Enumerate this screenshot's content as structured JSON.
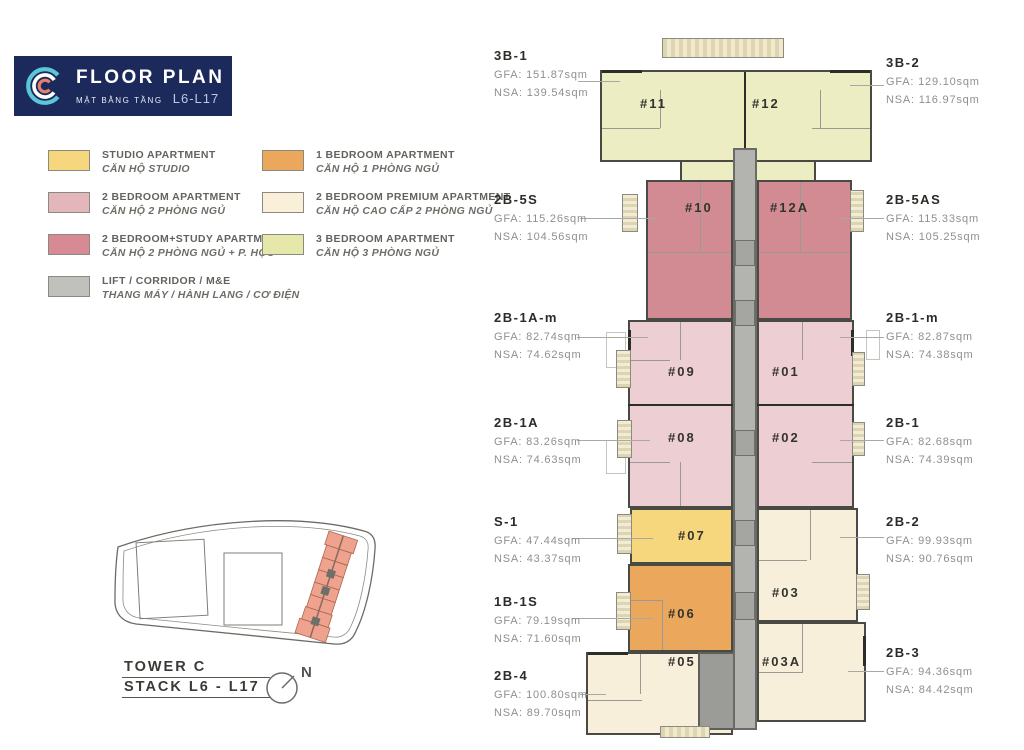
{
  "header": {
    "title": "FLOOR PLAN",
    "subtitle_vi": "MẶT BẰNG TẦNG",
    "levels": "L6-L17"
  },
  "legend": {
    "items": [
      {
        "label": "STUDIO APARTMENT",
        "label_vi": "CĂN HỘ STUDIO",
        "color": "#F6D77E"
      },
      {
        "label": "1 BEDROOM APARTMENT",
        "label_vi": "CĂN HỘ 1 PHÒNG NGỦ",
        "color": "#EBA85C"
      },
      {
        "label": "2 BEDROOM APARTMENT",
        "label_vi": "CĂN HỘ 2 PHÒNG NGỦ",
        "color": "#E3B6BC"
      },
      {
        "label": "2 BEDROOM PREMIUM APARTMENT",
        "label_vi": "CĂN HỘ CAO CẤP 2 PHÒNG NGỦ",
        "color": "#FAF0DA"
      },
      {
        "label": "2 BEDROOM+STUDY APARTMENT",
        "label_vi": "CĂN HỘ 2 PHÒNG NGỦ + P. HỌC",
        "color": "#D88A94"
      },
      {
        "label": "3 BEDROOM APARTMENT",
        "label_vi": "CĂN HỘ 3 PHÒNG NGỦ",
        "color": "#E5E8A9"
      },
      {
        "label": "LIFT / CORRIDOR / M&E",
        "label_vi": "THANG MÁY / HÀNH LANG / CƠ ĐIỆN",
        "color": "#C0C0BC"
      }
    ]
  },
  "site_plan": {
    "tower_label": "TOWER C",
    "stack_label": "STACK L6 - L17",
    "north_label": "N",
    "highlight_color": "#EFA28E"
  },
  "plan": {
    "units": [
      {
        "id": "#11",
        "type": "3-bedroom",
        "color": "#ECEDC3"
      },
      {
        "id": "#12",
        "type": "3-bedroom",
        "color": "#ECEDC3"
      },
      {
        "id": "#10",
        "type": "2-bedroom-study",
        "color": "#D28B92"
      },
      {
        "id": "#12A",
        "type": "2-bedroom-study",
        "color": "#D28B92"
      },
      {
        "id": "#09",
        "type": "2-bedroom",
        "color": "#EDCED2"
      },
      {
        "id": "#01",
        "type": "2-bedroom",
        "color": "#EDCED2"
      },
      {
        "id": "#08",
        "type": "2-bedroom",
        "color": "#EDCED2"
      },
      {
        "id": "#02",
        "type": "2-bedroom",
        "color": "#EDCED2"
      },
      {
        "id": "#07",
        "type": "studio",
        "color": "#F6D77E"
      },
      {
        "id": "#03",
        "type": "2-bedroom-premium",
        "color": "#F7EFD9"
      },
      {
        "id": "#06",
        "type": "1-bedroom",
        "color": "#EBA85C"
      },
      {
        "id": "#05",
        "type": "2-bedroom-premium",
        "color": "#F7EFD9"
      },
      {
        "id": "#03A",
        "type": "2-bedroom-premium",
        "color": "#F7EFD9"
      }
    ],
    "corridor_color": "#B3B3AF",
    "core_color": "#9B9B97",
    "annotations_left": [
      {
        "code": "3B-1",
        "gfa": "GFA: 151.87sqm",
        "nsa": "NSA: 139.54sqm"
      },
      {
        "code": "2B-5S",
        "gfa": "GFA: 115.26sqm",
        "nsa": "NSA: 104.56sqm"
      },
      {
        "code": "2B-1A-m",
        "gfa": "GFA: 82.74sqm",
        "nsa": "NSA: 74.62sqm"
      },
      {
        "code": "2B-1A",
        "gfa": "GFA: 83.26sqm",
        "nsa": "NSA: 74.63sqm"
      },
      {
        "code": "S-1",
        "gfa": "GFA: 47.44sqm",
        "nsa": "NSA: 43.37sqm"
      },
      {
        "code": "1B-1S",
        "gfa": "GFA: 79.19sqm",
        "nsa": "NSA: 71.60sqm"
      },
      {
        "code": "2B-4",
        "gfa": "GFA: 100.80sqm",
        "nsa": "NSA: 89.70sqm"
      }
    ],
    "annotations_right": [
      {
        "code": "3B-2",
        "gfa": "GFA: 129.10sqm",
        "nsa": "NSA: 116.97sqm"
      },
      {
        "code": "2B-5AS",
        "gfa": "GFA: 115.33sqm",
        "nsa": "NSA: 105.25sqm"
      },
      {
        "code": "2B-1-m",
        "gfa": "GFA: 82.87sqm",
        "nsa": "NSA: 74.38sqm"
      },
      {
        "code": "2B-1",
        "gfa": "GFA: 82.68sqm",
        "nsa": "NSA: 74.39sqm"
      },
      {
        "code": "2B-2",
        "gfa": "GFA: 99.93sqm",
        "nsa": "NSA: 90.76sqm"
      },
      {
        "code": "2B-3",
        "gfa": "GFA: 94.36sqm",
        "nsa": "NSA: 84.42sqm"
      }
    ]
  }
}
